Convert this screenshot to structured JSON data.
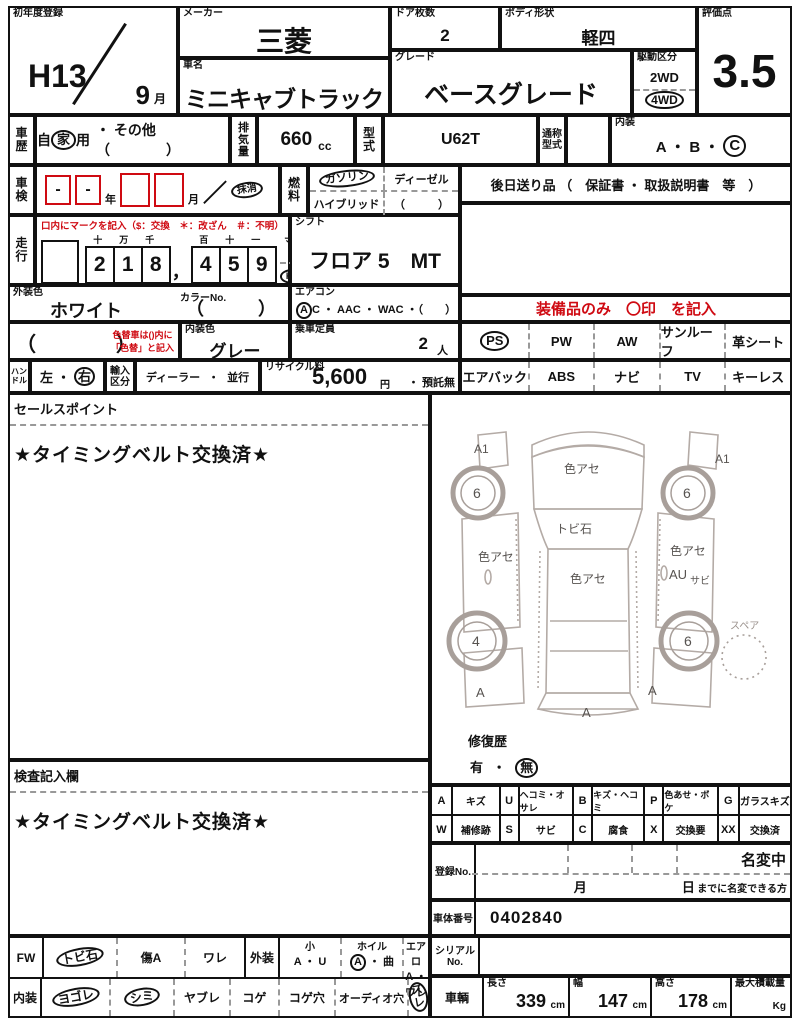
{
  "top": {
    "first_reg": {
      "label": "初年度登録",
      "year": "H13",
      "month": "9",
      "month_unit": "月"
    },
    "maker": {
      "label": "メーカー",
      "value": "三菱"
    },
    "car_name": {
      "label": "車名",
      "value": "ミニキャブトラック"
    },
    "doors": {
      "label": "ドア枚数",
      "value": "2"
    },
    "body": {
      "label": "ボディ形状",
      "value": "軽四"
    },
    "grade": {
      "label": "グレード",
      "value": "ベースグレード"
    },
    "drive": {
      "label": "駆動区分",
      "opt1": "2WD",
      "opt2": "4WD"
    },
    "score": {
      "label": "評価点",
      "value": "3.5"
    }
  },
  "info": {
    "history": {
      "label": "車歴",
      "p1": "自",
      "p2": "家",
      "p3": "用",
      "other": "・ その他 （　　　　）"
    },
    "displacement": {
      "label": "排気量",
      "value": "660",
      "unit": "cc"
    },
    "model": {
      "label": "型式",
      "value": "U62T"
    },
    "common_model": {
      "label": "通称型式",
      "value": ""
    },
    "interior_grade": {
      "label": "内装",
      "pre": "A ・ B ・",
      "selected": "C"
    },
    "shaken": {
      "label": "車検",
      "b1": "-",
      "b2": "-",
      "year": "年",
      "month": "月",
      "slash": "／",
      "removed": "抹消"
    },
    "fuel": {
      "label": "燃料",
      "gasoline": "ガソリン",
      "diesel": "ディーゼル",
      "hybrid": "ハイブリッド",
      "paren": "（　　　）"
    },
    "later_items": "後日送り品 （　保証書 ・ 取扱説明書　等　）",
    "odo_note": "口内にマークを記入（$：交換　＊：改ざん　＃：不明）",
    "mileage": {
      "label": "走行",
      "h": [
        "十",
        "万",
        "千",
        "百",
        "十",
        "一"
      ],
      "d": [
        "2",
        "1",
        "8",
        "4",
        "5",
        "9"
      ],
      "comma": "，",
      "mile": "マイル",
      "km": "Km"
    },
    "shift": {
      "label": "シフト",
      "value": "フロア 5　MT"
    },
    "ext_color": {
      "label": "外装色",
      "value": "ホワイト",
      "color_no_label": "カラーNo.",
      "paren": "（　　　）"
    },
    "aircon": {
      "label": "エアコン",
      "a": "A",
      "rest": "C ・ AAC ・ WAC ・（　　）"
    },
    "repaint": {
      "paren": "（　　　　）",
      "note1": "色替車は()内に",
      "note2": "「色替」と記入"
    },
    "int_color": {
      "label": "内装色",
      "value": "グレー"
    },
    "capacity": {
      "label": "乗車定員",
      "value": "2",
      "unit": "人"
    },
    "handle": {
      "label": "ハンドル",
      "left": "左",
      "sep": "・",
      "right": "右"
    },
    "import": {
      "label": "輸入区分",
      "dealer": "ディーラー",
      "sep": "・",
      "parallel": "並行"
    },
    "recycle": {
      "label": "リサイクル料",
      "value": "5,600",
      "yen": "円",
      "deposit": "・ 預託無"
    },
    "equip_note": "装備品のみ　〇印　を記入",
    "equip_row1": [
      "PS",
      "PW",
      "AW",
      "サンルーフ",
      "革シート"
    ],
    "equip_row2": [
      "エアバック",
      "ABS",
      "ナビ",
      "TV",
      "キーレス"
    ]
  },
  "sales": {
    "label": "セールスポイント",
    "text": "★タイミングベルト交換済★"
  },
  "inspection": {
    "label": "検査記入欄",
    "text": "★タイミングベルト交換済★"
  },
  "diagram": {
    "a1_left": "A1",
    "a1_right": "A1",
    "hood": "色アセ",
    "windshield": "トビ石",
    "left_door": "色アセ",
    "right_upper": "色アセ",
    "right_mark": "AU",
    "right_rust": "サビ",
    "roof": "色アセ",
    "wheel_fl": "6",
    "wheel_fr": "6",
    "wheel_rl": "4",
    "wheel_rr": "6",
    "spare": "スペア",
    "a_left": "A",
    "a_center": "A",
    "a_right": "A",
    "repair": {
      "label": "修復歴",
      "yes": "有",
      "dot": "・",
      "no": "無"
    }
  },
  "legend": {
    "row1": [
      {
        "c": "A",
        "d": "キズ"
      },
      {
        "c": "U",
        "d": "ヘコミ・オサレ"
      },
      {
        "c": "B",
        "d": "キズ・ヘコミ"
      },
      {
        "c": "P",
        "d": "色あせ・ボケ"
      },
      {
        "c": "G",
        "d": "ガラスキズ"
      }
    ],
    "row2": [
      {
        "c": "W",
        "d": "補修跡"
      },
      {
        "c": "S",
        "d": "サビ"
      },
      {
        "c": "C",
        "d": "腐食"
      },
      {
        "c": "X",
        "d": "交換要"
      },
      {
        "c": "XX",
        "d": "交換済"
      }
    ]
  },
  "registration": {
    "label": "登録No.",
    "name_change": "名変中",
    "month": "月",
    "day": "日",
    "note": "までに名変できる方"
  },
  "chassis": {
    "label": "車体番号",
    "value": "0402840"
  },
  "serial": {
    "label": "シリアルNo."
  },
  "bottom_left": {
    "fw": {
      "label": "FW",
      "i1": "トビ石",
      "i2": "傷A",
      "i3": "ワレ"
    },
    "ext": {
      "label": "外装",
      "small": "小",
      "small_opts": "A ・ U",
      "wheel": "ホイル",
      "wheel_a": "A",
      "wheel_rest": "・ 曲",
      "aero": "エアロ",
      "aero_opts": "A ・ ワレ"
    },
    "int": {
      "label": "内装",
      "i1": "ヨゴレ",
      "i2": "シミ",
      "i3": "ヤブレ",
      "i4": "コゲ",
      "i5": "コゲ穴",
      "i6": "オーディオ穴",
      "i7": "ズレ"
    }
  },
  "vehicle": {
    "label": "車輌",
    "len_label": "長さ",
    "len": "339",
    "wid_label": "幅",
    "wid": "147",
    "hgt_label": "高さ",
    "hgt": "178",
    "unit": "cm",
    "payload_label": "最大積載量",
    "payload_unit": "Kg"
  }
}
